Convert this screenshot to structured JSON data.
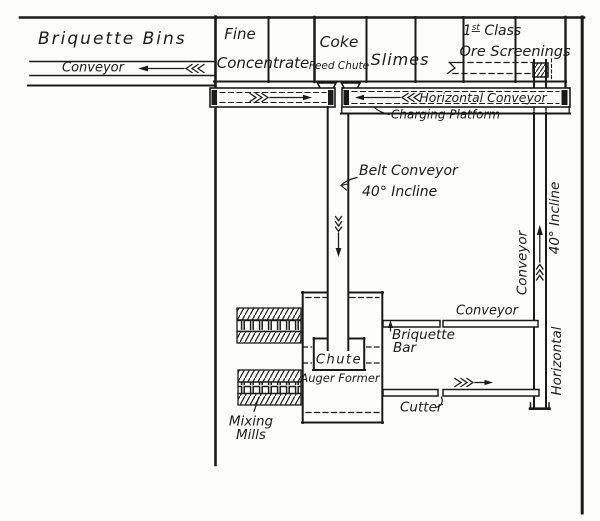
{
  "page": {
    "ink_color": "#1b1b1b",
    "paper_color": "#fdfdfb"
  },
  "bins": {
    "briquette_bins": "Briquette Bins",
    "bins_conveyor": "Conveyor",
    "fine": "Fine",
    "concentrate": "Concentrate",
    "coke": "Coke",
    "feed_chute": "Feed Chute",
    "slimes": "Slimes",
    "first_class_num": "1",
    "first_class_sup": "st",
    "first_class_rest": " Class",
    "ore_screenings": "Ore Screenings"
  },
  "platform": {
    "horizontal_conveyor": "Horizontal Conveyor",
    "charging_platform": "Charging Platform"
  },
  "belt_conveyor": {
    "name": "Belt Conveyor",
    "incline": "40° Incline"
  },
  "press": {
    "chute": "Chute",
    "auger_former": "Auger Former",
    "mixing": "Mixing",
    "mills": "Mills"
  },
  "output": {
    "conveyor": "Conveyor",
    "briquette": "Briquette",
    "bar": "Bar",
    "cutter": "Cutter"
  },
  "elevator": {
    "conveyor": "Conveyor",
    "incline": "40° Incline",
    "horizontal": "Horizontal"
  }
}
